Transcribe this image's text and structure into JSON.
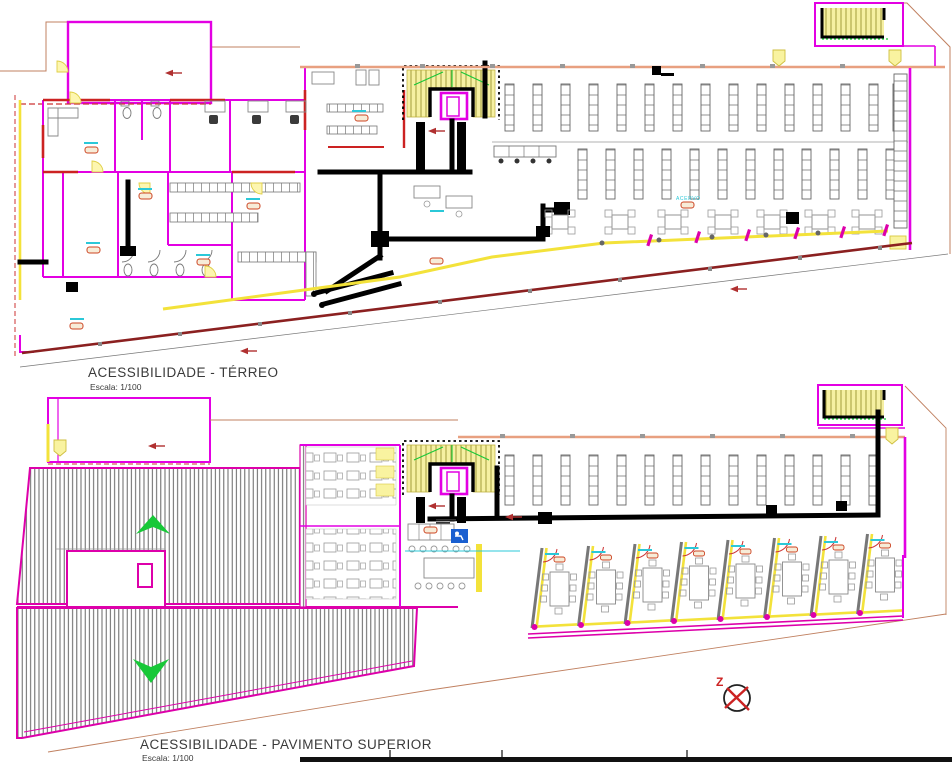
{
  "document": {
    "kind": "accessibility-floor-plan-drawing",
    "sheet_bottom_bar": true
  },
  "plans": {
    "terreo": {
      "title": "ACESSIBILIDADE - TÉRREO",
      "scale": "Escala: 1/100"
    },
    "superior": {
      "title": "ACESSIBILIDADE - PAVIMENTO SUPERIOR",
      "scale": "Escala: 1/100"
    }
  },
  "labels": {
    "acervo": "ACERVO"
  },
  "north": {
    "label": "Z"
  },
  "colors": {
    "wall_magenta": "#e300e3",
    "wall_salmon": "#e8a080",
    "route_black": "#000000",
    "path_yellow": "#f3e23a",
    "stair_fill": "#f6f0a2",
    "boundary_brown": "#c08060",
    "annotation_red": "#b03030",
    "dark_red_wall": "#8b2020",
    "hatch_gray": "#555555",
    "slope_green": "#18c838",
    "cyan_label": "#2bc8d8",
    "blue_icon": "#1a5fd0",
    "orange_tag": "#cc4422",
    "furniture_gray": "#888888"
  }
}
